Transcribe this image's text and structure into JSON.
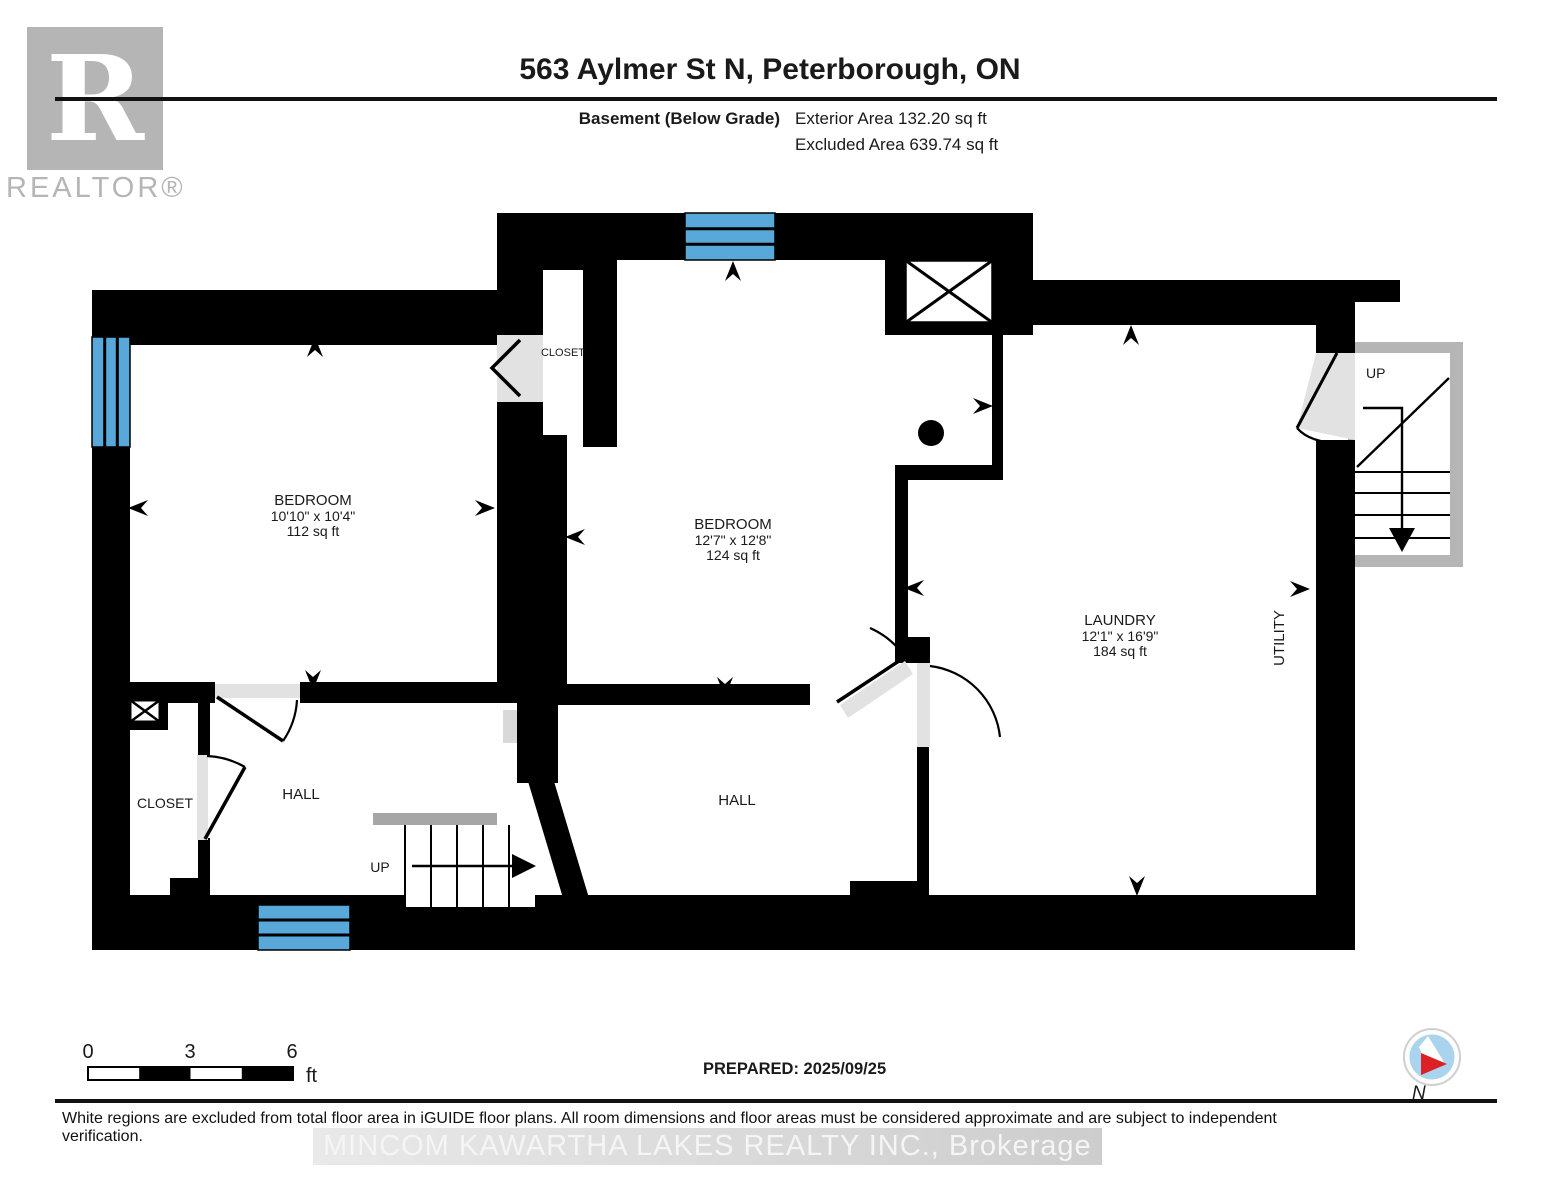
{
  "header": {
    "title": "563 Aylmer St N, Peterborough, ON",
    "floor_label": "Basement (Below Grade)",
    "exterior_area": "Exterior Area 132.20 sq ft",
    "excluded_area": "Excluded Area 639.74 sq ft"
  },
  "branding": {
    "logo_letter": "R",
    "logo_wordmark": "REALTOR®"
  },
  "rooms": [
    {
      "name": "BEDROOM",
      "dims": "10'10\" x 10'4\"",
      "area": "112 sq ft"
    },
    {
      "name": "BEDROOM",
      "dims": "12'7\" x 12'8\"",
      "area": "124 sq ft"
    },
    {
      "name": "LAUNDRY",
      "dims": "12'1\" x 16'9\"",
      "area": "184 sq ft"
    }
  ],
  "labels": {
    "utility": "UTILITY",
    "hall_left": "HALL",
    "hall_right": "HALL",
    "closet_left": "CLOSET",
    "closet_middle": "CLOSET",
    "stairs_up_interior": "UP",
    "stairs_up_exterior": "UP"
  },
  "scale_bar": {
    "tick_0": "0",
    "tick_3": "3",
    "tick_6": "6",
    "unit": "ft"
  },
  "prepared_label": "PREPARED: 2025/09/25",
  "compass": {
    "north_label": "N"
  },
  "footer": {
    "disclaimer": "White regions are excluded from total floor area in iGUIDE floor plans. All room dimensions and floor areas must be considered approximate and are subject to independent verification.",
    "watermark": "MINCOM KAWARTHA LAKES REALTY INC., Brokerage"
  },
  "colors": {
    "wall_black": "#000000",
    "window_blue": "#58a9da",
    "door_grey": "#e2e2e2",
    "stair_frame_grey": "#b5b5b5",
    "logo_grey": "#b5b5b5",
    "compass_red": "#dd1f26",
    "compass_blue": "#aad3ed"
  }
}
